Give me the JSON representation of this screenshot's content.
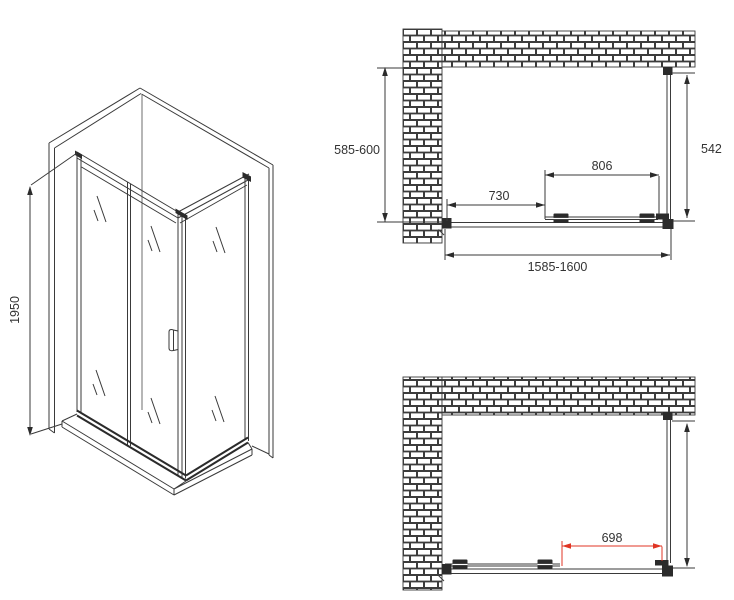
{
  "drawing": {
    "isometric": {
      "height_label": "1950"
    },
    "plan_top": {
      "depth_label": "585-600",
      "side_panel_label": "542",
      "door_width_label": "806",
      "fixed_panel_label": "730",
      "total_width_label": "1585-1600"
    },
    "plan_bottom": {
      "opening_width_label": "698"
    }
  },
  "colors": {
    "line": "#3a3a3a",
    "dark_fill": "#2b2b2b",
    "accent_red": "#e03524",
    "background": "#ffffff"
  }
}
